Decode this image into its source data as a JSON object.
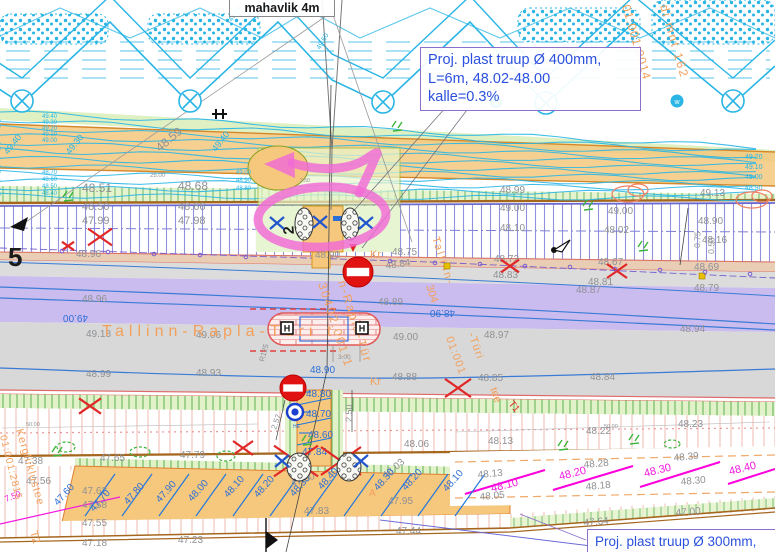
{
  "boxes": {
    "top_label": "mahavlik 4m",
    "proj400": {
      "line1": "Proj. plast truup Ø 400mm,",
      "line2": "L=6m, 48.02-48.00",
      "line3": "kalle=0.3%"
    },
    "proj300": "Proj. plast truup Ø 300mm,"
  },
  "palette": {
    "g": "#8f9194",
    "b": "#2e6fd6",
    "c": "#29b6e6",
    "m": "#f318e0",
    "o": "#f2a05c",
    "r": "#e02828",
    "k": "#1a1a1a"
  },
  "road_name": "Tallinn-Rapla-Türi t",
  "labels": [
    {
      "t": "48.59",
      "x": 160,
      "y": 152,
      "r": -40,
      "s": 12
    },
    {
      "t": "48.51",
      "x": 82,
      "y": 192,
      "s": 12
    },
    {
      "t": "48.68",
      "x": 178,
      "y": 190,
      "s": 12
    },
    {
      "t": "48.50",
      "x": 82,
      "y": 210,
      "s": 11
    },
    {
      "t": "48.66",
      "x": 178,
      "y": 210,
      "s": 11
    },
    {
      "t": "47.99",
      "x": 82,
      "y": 224,
      "s": 11
    },
    {
      "t": "47.98",
      "x": 178,
      "y": 224,
      "s": 11
    },
    {
      "t": "25.00",
      "x": 150,
      "y": 177,
      "s": 6
    },
    {
      "t": "48.99",
      "x": 500,
      "y": 193
    },
    {
      "t": "49.00",
      "x": 500,
      "y": 211
    },
    {
      "t": "49.00",
      "x": 608,
      "y": 214
    },
    {
      "t": "48.10",
      "x": 500,
      "y": 231
    },
    {
      "t": "48.02",
      "x": 604,
      "y": 233
    },
    {
      "t": "49.13",
      "x": 700,
      "y": 196
    },
    {
      "t": "48.90",
      "x": 698,
      "y": 224
    },
    {
      "t": "48.16",
      "x": 702,
      "y": 243
    },
    {
      "t": "48.69",
      "x": 694,
      "y": 270
    },
    {
      "t": "48.79",
      "x": 694,
      "y": 291
    },
    {
      "t": "48.72",
      "x": 494,
      "y": 262
    },
    {
      "t": "48.67",
      "x": 598,
      "y": 265
    },
    {
      "t": "48.83",
      "x": 493,
      "y": 278
    },
    {
      "t": "48.81",
      "x": 588,
      "y": 285
    },
    {
      "t": "48.75",
      "x": 392,
      "y": 255
    },
    {
      "t": "48.84",
      "x": 386,
      "y": 269,
      "r": -8
    },
    {
      "t": "48.89",
      "x": 378,
      "y": 305
    },
    {
      "t": "48.96",
      "x": 82,
      "y": 302
    },
    {
      "t": "48.96",
      "x": 76,
      "y": 257
    },
    {
      "t": "48.90",
      "x": 315,
      "y": 258
    },
    {
      "t": "49.18",
      "x": 86,
      "y": 337
    },
    {
      "t": "49.06",
      "x": 196,
      "y": 338
    },
    {
      "t": "49.00",
      "x": 393,
      "y": 340
    },
    {
      "t": "48.97",
      "x": 484,
      "y": 338
    },
    {
      "t": "48.87",
      "x": 576,
      "y": 293
    },
    {
      "t": "48.94",
      "x": 680,
      "y": 332
    },
    {
      "t": "48.99",
      "x": 86,
      "y": 377
    },
    {
      "t": "48.93",
      "x": 196,
      "y": 376
    },
    {
      "t": "48.88",
      "x": 392,
      "y": 380
    },
    {
      "t": "48.85",
      "x": 478,
      "y": 381
    },
    {
      "t": "48.84",
      "x": 590,
      "y": 380
    },
    {
      "t": "48.06",
      "x": 404,
      "y": 447
    },
    {
      "t": "48.13",
      "x": 488,
      "y": 444
    },
    {
      "t": "48.22",
      "x": 586,
      "y": 434
    },
    {
      "t": "48.23",
      "x": 678,
      "y": 427
    },
    {
      "t": "47.38",
      "x": 18,
      "y": 464
    },
    {
      "t": "47.65",
      "x": 100,
      "y": 461
    },
    {
      "t": "47.79",
      "x": 180,
      "y": 458
    },
    {
      "t": "47.56",
      "x": 26,
      "y": 484
    },
    {
      "t": "47.62",
      "x": 82,
      "y": 494
    },
    {
      "t": "47.58",
      "x": 82,
      "y": 508
    },
    {
      "t": "47.55",
      "x": 82,
      "y": 526
    },
    {
      "t": "47.18",
      "x": 82,
      "y": 546
    },
    {
      "t": "47.23",
      "x": 178,
      "y": 543
    },
    {
      "t": "48.28",
      "x": 584,
      "y": 468,
      "r": -5
    },
    {
      "t": "48.18",
      "x": 586,
      "y": 490,
      "r": -5
    },
    {
      "t": "48.13",
      "x": 478,
      "y": 478,
      "r": -5
    },
    {
      "t": "48.05",
      "x": 480,
      "y": 500,
      "r": -5
    },
    {
      "t": "48.30",
      "x": 681,
      "y": 485,
      "r": -5
    },
    {
      "t": "48.39",
      "x": 674,
      "y": 461,
      "r": -5
    },
    {
      "t": "47.64",
      "x": 584,
      "y": 526,
      "r": -5
    },
    {
      "t": "47.00",
      "x": 676,
      "y": 516,
      "r": -5
    },
    {
      "t": "47.44",
      "x": 396,
      "y": 534
    },
    {
      "t": "47.90",
      "x": 292,
      "y": 487,
      "r": -20
    },
    {
      "t": "47.83",
      "x": 304,
      "y": 514
    },
    {
      "t": "48.03",
      "x": 386,
      "y": 479,
      "r": -40
    },
    {
      "t": "47.95",
      "x": 388,
      "y": 504
    },
    {
      "t": "50.00",
      "x": 26,
      "y": 426,
      "s": 5.5
    },
    {
      "t": "50.00",
      "x": 604,
      "y": 428,
      "s": 5.5
    },
    {
      "t": "3.00",
      "x": 338,
      "y": 359,
      "s": 6.5
    },
    {
      "t": "3.50",
      "x": 300,
      "y": 182,
      "s": 5
    },
    {
      "t": "2.57",
      "x": 276,
      "y": 430,
      "r": -70,
      "s": 8
    },
    {
      "t": "2.50",
      "x": 352,
      "y": 422,
      "r": -90,
      "s": 9
    },
    {
      "t": "R125",
      "x": 264,
      "y": 362,
      "r": -75,
      "s": 7.5
    },
    {
      "t": "0.75",
      "x": 700,
      "y": 248,
      "r": -88,
      "s": 8.5
    },
    {
      "t": "0.50",
      "x": 714,
      "y": 254,
      "r": -88,
      "s": 8.5
    },
    {
      "t": "48.80",
      "x": 306,
      "y": 397,
      "c": "b"
    },
    {
      "t": "48.70",
      "x": 306,
      "y": 417,
      "c": "b"
    },
    {
      "t": "48.60",
      "x": 308,
      "y": 438,
      "c": "b"
    },
    {
      "t": "47.84",
      "x": 302,
      "y": 455,
      "c": "b"
    },
    {
      "t": "48.90",
      "x": 310,
      "y": 373,
      "c": "b"
    },
    {
      "t": "48.90",
      "x": 455,
      "y": 310,
      "r": 180,
      "c": "b"
    },
    {
      "t": "49.00",
      "x": 88,
      "y": 315,
      "r": 180,
      "c": "b"
    },
    {
      "t": "HE",
      "x": 293,
      "y": 428,
      "c": "b",
      "s": 5
    },
    {
      "t": "47.60",
      "x": 58,
      "y": 506,
      "r": -48,
      "c": "b"
    },
    {
      "t": "47.70",
      "x": 94,
      "y": 512,
      "r": -48,
      "c": "b"
    },
    {
      "t": "47.80",
      "x": 128,
      "y": 505,
      "r": -48,
      "c": "b"
    },
    {
      "t": "47.90",
      "x": 160,
      "y": 503,
      "r": -48,
      "c": "b"
    },
    {
      "t": "48.00",
      "x": 192,
      "y": 502,
      "r": -48,
      "c": "b"
    },
    {
      "t": "48.10",
      "x": 228,
      "y": 498,
      "r": -48,
      "c": "b"
    },
    {
      "t": "48.20",
      "x": 258,
      "y": 498,
      "r": -48,
      "c": "b"
    },
    {
      "t": "48.30",
      "x": 294,
      "y": 497,
      "r": -48,
      "c": "b"
    },
    {
      "t": "48.40",
      "x": 322,
      "y": 490,
      "r": -48,
      "c": "b"
    },
    {
      "t": "48.30",
      "x": 378,
      "y": 491,
      "r": -48,
      "c": "b"
    },
    {
      "t": "48.20",
      "x": 406,
      "y": 491,
      "r": -48,
      "c": "b"
    },
    {
      "t": "48.10",
      "x": 447,
      "y": 492,
      "r": -48,
      "c": "b"
    },
    {
      "t": "49.40",
      "x": 42,
      "y": 118,
      "c": "c",
      "s": 6
    },
    {
      "t": "49.30",
      "x": 42,
      "y": 124,
      "c": "c",
      "s": 6
    },
    {
      "t": "49.20",
      "x": 42,
      "y": 130,
      "c": "c",
      "s": 6
    },
    {
      "t": "49.10",
      "x": 42,
      "y": 136,
      "c": "c",
      "s": 6
    },
    {
      "t": "49.00",
      "x": 42,
      "y": 142,
      "c": "c",
      "s": 6
    },
    {
      "t": "48.70",
      "x": 42,
      "y": 174,
      "c": "c",
      "s": 6
    },
    {
      "t": "48.60",
      "x": 42,
      "y": 181,
      "c": "c",
      "s": 6
    },
    {
      "t": "48.50",
      "x": 42,
      "y": 188,
      "c": "c",
      "s": 6
    },
    {
      "t": "48.40",
      "x": 42,
      "y": 195,
      "c": "c",
      "s": 6
    },
    {
      "t": "49.00",
      "x": 236,
      "y": 174,
      "c": "c",
      "s": 6
    },
    {
      "t": "48.90",
      "x": 236,
      "y": 182,
      "c": "c",
      "s": 6
    },
    {
      "t": "48.80",
      "x": 236,
      "y": 190,
      "c": "c",
      "s": 6
    },
    {
      "t": "49.20",
      "x": 745,
      "y": 159,
      "c": "c",
      "s": 7
    },
    {
      "t": "49.10",
      "x": 745,
      "y": 169,
      "c": "c",
      "s": 7
    },
    {
      "t": "49.00",
      "x": 745,
      "y": 179,
      "c": "c",
      "s": 7
    },
    {
      "t": "48.90",
      "x": 745,
      "y": 190,
      "c": "c",
      "s": 7
    },
    {
      "t": "49.40",
      "x": 8,
      "y": 155,
      "r": -52,
      "c": "c",
      "s": 9
    },
    {
      "t": "49.30",
      "x": 70,
      "y": 155,
      "r": -52,
      "c": "c",
      "s": 9
    },
    {
      "t": "49.40",
      "x": 216,
      "y": 152,
      "r": -52,
      "c": "c",
      "s": 9
    },
    {
      "t": "49.60",
      "x": 232,
      "y": 22,
      "r": -60,
      "c": "c",
      "s": 7
    },
    {
      "t": "49.60",
      "x": 320,
      "y": 50,
      "r": -60,
      "c": "c",
      "s": 7
    },
    {
      "t": "48.10",
      "x": 492,
      "y": 492,
      "r": -14,
      "c": "m",
      "s": 11
    },
    {
      "t": "48.20",
      "x": 560,
      "y": 480,
      "r": -14,
      "c": "m",
      "s": 11
    },
    {
      "t": "48.30",
      "x": 645,
      "y": 477,
      "r": -14,
      "c": "m",
      "s": 11
    },
    {
      "t": "48.40",
      "x": 730,
      "y": 475,
      "r": -14,
      "c": "m",
      "s": 11
    },
    {
      "t": "7.50",
      "x": 6,
      "y": 502,
      "r": -22,
      "c": "m",
      "s": 8.5
    },
    {
      "t": "Tallinn-Rapla-Türi t",
      "x": 102,
      "y": 336,
      "c": "o",
      "s": 16,
      "l": 5
    },
    {
      "t": "n-Rapla-Tür",
      "x": 338,
      "y": 282,
      "r": 72,
      "c": "o",
      "s": 12,
      "l": 2
    },
    {
      "t": "30402:001:1",
      "x": 318,
      "y": 284,
      "r": 72,
      "c": "o",
      "s": 12,
      "l": 2
    },
    {
      "t": "Tallinn-",
      "x": 432,
      "y": 238,
      "r": 72,
      "c": "o",
      "s": 11,
      "l": 2
    },
    {
      "t": "304",
      "x": 426,
      "y": 286,
      "r": 72,
      "c": "o",
      "s": 11
    },
    {
      "t": "01:001",
      "x": 446,
      "y": 338,
      "r": 70,
      "c": "o",
      "s": 11,
      "l": 1
    },
    {
      "t": "-Türi",
      "x": 468,
      "y": 334,
      "r": 70,
      "c": "o",
      "s": 11,
      "l": 1
    },
    {
      "t": "tee",
      "x": 490,
      "y": 389,
      "r": 70,
      "c": "o",
      "s": 11
    },
    {
      "t": "Kr",
      "x": 370,
      "y": 258,
      "c": "o",
      "s": 11
    },
    {
      "t": "Kr",
      "x": 370,
      "y": 385,
      "c": "o",
      "s": 11
    },
    {
      "t": "A",
      "x": 369,
      "y": 496,
      "c": "o",
      "s": 10
    },
    {
      "t": "di mnt 162",
      "x": 660,
      "y": 6,
      "r": 74,
      "c": "o",
      "s": 12,
      "l": 2
    },
    {
      "t": "01:001:0014",
      "x": 622,
      "y": 6,
      "r": 74,
      "c": "o",
      "s": 12,
      "l": 1
    },
    {
      "t": "Kergliiklustee",
      "x": 16,
      "y": 430,
      "r": 74,
      "c": "o",
      "s": 11,
      "l": 1
    },
    {
      "t": "T2",
      "x": 30,
      "y": 532,
      "r": 74,
      "c": "o",
      "s": 11
    },
    {
      "t": "01:001:2815",
      "x": 0,
      "y": 436,
      "r": 76,
      "c": "o",
      "s": 10,
      "l": 1
    },
    {
      "t": "T1",
      "x": 508,
      "y": 404,
      "r": 50,
      "c": "r",
      "s": 10
    },
    {
      "t": "5",
      "x": 8,
      "y": 266,
      "c": "k",
      "s": 26,
      "w": 700
    },
    {
      "t": "2",
      "x": 294,
      "y": 234,
      "r": -95,
      "c": "k",
      "s": 15,
      "w": 700
    }
  ],
  "symbols": {
    "red_crosses": [
      [
        100,
        237,
        12
      ],
      [
        510,
        266,
        9
      ],
      [
        617,
        271,
        10
      ],
      [
        296,
        461,
        22
      ],
      [
        341,
        461,
        20
      ],
      [
        458,
        388,
        13
      ],
      [
        90,
        406,
        11
      ],
      [
        243,
        448,
        10
      ],
      [
        68,
        246,
        6
      ]
    ],
    "signs": [
      [
        358,
        272,
        15
      ],
      [
        293,
        388,
        13
      ]
    ],
    "manholes": [
      [
        295,
        412,
        8
      ]
    ],
    "grass": [
      [
        397,
        127
      ],
      [
        588,
        206
      ],
      [
        643,
        247
      ],
      [
        68,
        197
      ],
      [
        57,
        452
      ],
      [
        307,
        441
      ],
      [
        563,
        446
      ],
      [
        634,
        440
      ]
    ],
    "green_blobs": [
      [
        66,
        447,
        9,
        5
      ],
      [
        140,
        452,
        10,
        5
      ],
      [
        226,
        456,
        9,
        5
      ],
      [
        672,
        444,
        8,
        4
      ]
    ],
    "orange_scribbles": [
      [
        628,
        194
      ],
      [
        752,
        200
      ]
    ],
    "circle_x": [
      [
        22,
        101
      ],
      [
        190,
        101
      ],
      [
        383,
        102
      ],
      [
        546,
        103
      ],
      [
        733,
        101
      ]
    ],
    "circle_w": [
      [
        496,
        102
      ],
      [
        677,
        101
      ]
    ],
    "headwalls": [
      [
        304,
        224,
        9,
        16
      ],
      [
        350,
        224,
        9,
        16
      ],
      [
        299,
        467,
        12,
        14
      ],
      [
        349,
        467,
        12,
        14
      ]
    ],
    "blue_x": [
      [
        277,
        223
      ],
      [
        320,
        222
      ],
      [
        366,
        223
      ],
      [
        282,
        461
      ],
      [
        361,
        461
      ]
    ],
    "h_markers": [
      [
        287,
        328
      ],
      [
        362,
        328
      ]
    ],
    "flags": [
      [
        554,
        250
      ]
    ],
    "yellow_dots": [
      [
        447,
        266
      ],
      [
        702,
        276
      ]
    ],
    "purple_dots": [
      [
        62,
        251
      ],
      [
        108,
        252
      ],
      [
        154,
        254
      ],
      [
        200,
        255
      ],
      [
        246,
        257
      ],
      [
        390,
        261
      ],
      [
        435,
        263
      ],
      [
        480,
        264
      ],
      [
        525,
        266
      ],
      [
        570,
        267
      ],
      [
        615,
        269
      ],
      [
        660,
        270
      ],
      [
        705,
        272
      ],
      [
        750,
        274
      ]
    ]
  }
}
